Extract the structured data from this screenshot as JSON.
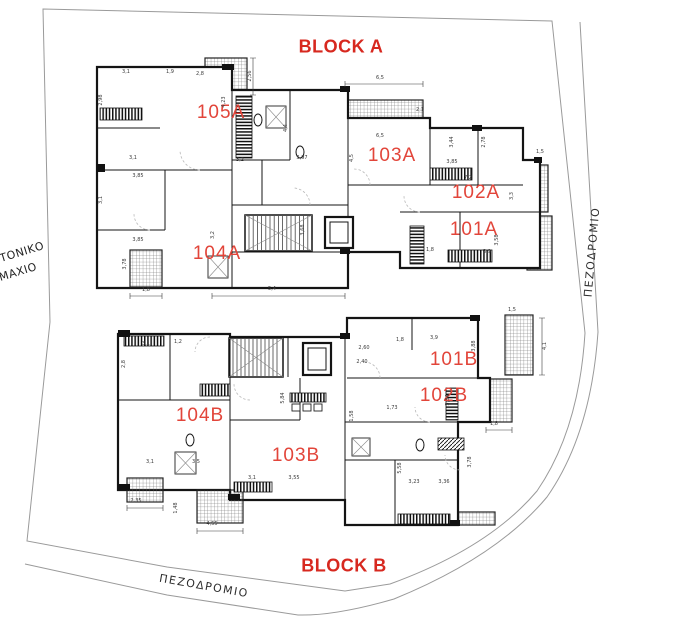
{
  "colors": {
    "block_label": "#d7281f",
    "unit_label": "#e2453a",
    "drawing": "#141414",
    "site_line": "#9a9a9a",
    "dimension_text": "#3a3a3a",
    "road_text": "#2e2e2e"
  },
  "labels": {
    "block_a": "BLOCK A",
    "block_b": "BLOCK B",
    "road_right": "ΠΕΖΟΔΡΟΜΙΟ",
    "road_bottom": "ΠΕΖΟΔΡΟΜΙΟ",
    "neighbor_line1": "ΤΟΝΙΚΟ",
    "neighbor_line2": "ΜΑΧΙΟ"
  },
  "units": [
    {
      "id": "105A",
      "x": 221,
      "y": 113
    },
    {
      "id": "103A",
      "x": 392,
      "y": 156
    },
    {
      "id": "102A",
      "x": 476,
      "y": 193
    },
    {
      "id": "101A",
      "x": 474,
      "y": 230
    },
    {
      "id": "104A",
      "x": 217,
      "y": 254
    },
    {
      "id": "101B",
      "x": 454,
      "y": 360
    },
    {
      "id": "102B",
      "x": 444,
      "y": 396
    },
    {
      "id": "104B",
      "x": 200,
      "y": 416
    },
    {
      "id": "103B",
      "x": 296,
      "y": 456
    }
  ],
  "dimensions": [
    {
      "t": "3,1",
      "x": 126,
      "y": 72,
      "r": 0
    },
    {
      "t": "1,9",
      "x": 170,
      "y": 72,
      "r": 0
    },
    {
      "t": "2,8",
      "x": 200,
      "y": 74,
      "r": 0
    },
    {
      "t": "2,98",
      "x": 101,
      "y": 100,
      "r": -90
    },
    {
      "t": "3,1",
      "x": 101,
      "y": 200,
      "r": -90
    },
    {
      "t": "3,1",
      "x": 133,
      "y": 158,
      "r": 0
    },
    {
      "t": "4,23",
      "x": 224,
      "y": 102,
      "r": -90
    },
    {
      "t": "2,56",
      "x": 250,
      "y": 76,
      "r": -90
    },
    {
      "t": "3,2",
      "x": 240,
      "y": 160,
      "r": 0
    },
    {
      "t": "3,97",
      "x": 302,
      "y": 158,
      "r": 0
    },
    {
      "t": "4,4",
      "x": 286,
      "y": 128,
      "r": -90
    },
    {
      "t": "3,85",
      "x": 138,
      "y": 176,
      "r": 0
    },
    {
      "t": "3,85",
      "x": 138,
      "y": 240,
      "r": 0
    },
    {
      "t": "3,78",
      "x": 125,
      "y": 264,
      "r": -90
    },
    {
      "t": "3,2",
      "x": 213,
      "y": 235,
      "r": -90
    },
    {
      "t": "6,5",
      "x": 380,
      "y": 78,
      "r": 0
    },
    {
      "t": "6,5",
      "x": 380,
      "y": 136,
      "r": 0
    },
    {
      "t": "4,5",
      "x": 352,
      "y": 158,
      "r": -90
    },
    {
      "t": "2,1",
      "x": 420,
      "y": 110,
      "r": 0
    },
    {
      "t": "2,78",
      "x": 484,
      "y": 142,
      "r": -90
    },
    {
      "t": "3,44",
      "x": 452,
      "y": 142,
      "r": -90
    },
    {
      "t": "3,85",
      "x": 452,
      "y": 162,
      "r": 0
    },
    {
      "t": "7,2",
      "x": 468,
      "y": 178,
      "r": 0
    },
    {
      "t": "3,3",
      "x": 512,
      "y": 196,
      "r": -90
    },
    {
      "t": "1,5",
      "x": 540,
      "y": 152,
      "r": 0
    },
    {
      "t": "3,58",
      "x": 497,
      "y": 240,
      "r": -90
    },
    {
      "t": "3,9",
      "x": 487,
      "y": 252,
      "r": 0
    },
    {
      "t": "1,8",
      "x": 430,
      "y": 250,
      "r": 0
    },
    {
      "t": "3,68",
      "x": 303,
      "y": 230,
      "r": -90
    },
    {
      "t": "5,4",
      "x": 272,
      "y": 289,
      "r": 0
    },
    {
      "t": "1,8",
      "x": 146,
      "y": 290,
      "r": 0
    },
    {
      "t": "3,1",
      "x": 146,
      "y": 344,
      "r": 0
    },
    {
      "t": "1,2",
      "x": 178,
      "y": 342,
      "r": 0
    },
    {
      "t": "2,8",
      "x": 124,
      "y": 364,
      "r": -90
    },
    {
      "t": "3,1",
      "x": 150,
      "y": 462,
      "r": 0
    },
    {
      "t": "3,5",
      "x": 196,
      "y": 462,
      "r": 0
    },
    {
      "t": "5,84",
      "x": 283,
      "y": 398,
      "r": -90
    },
    {
      "t": "3,1",
      "x": 252,
      "y": 478,
      "r": 0
    },
    {
      "t": "3,55",
      "x": 294,
      "y": 478,
      "r": 0
    },
    {
      "t": "2,60",
      "x": 364,
      "y": 348,
      "r": 0
    },
    {
      "t": "1,8",
      "x": 400,
      "y": 340,
      "r": 0
    },
    {
      "t": "3,9",
      "x": 434,
      "y": 338,
      "r": 0
    },
    {
      "t": "3,88",
      "x": 474,
      "y": 346,
      "r": -90
    },
    {
      "t": "2,40",
      "x": 362,
      "y": 362,
      "r": 0
    },
    {
      "t": "1,73",
      "x": 392,
      "y": 408,
      "r": 0
    },
    {
      "t": "1,58",
      "x": 352,
      "y": 416,
      "r": -90
    },
    {
      "t": "5,58",
      "x": 400,
      "y": 468,
      "r": -90
    },
    {
      "t": "3,23",
      "x": 414,
      "y": 482,
      "r": 0
    },
    {
      "t": "3,36",
      "x": 444,
      "y": 482,
      "r": 0
    },
    {
      "t": "3,78",
      "x": 470,
      "y": 462,
      "r": -90
    },
    {
      "t": "3,34",
      "x": 448,
      "y": 400,
      "r": -90
    },
    {
      "t": "4,55",
      "x": 212,
      "y": 524,
      "r": 0
    },
    {
      "t": "2,35",
      "x": 136,
      "y": 501,
      "r": 0
    },
    {
      "t": "1,48",
      "x": 176,
      "y": 508,
      "r": -90
    },
    {
      "t": "4,1",
      "x": 545,
      "y": 346,
      "r": -90
    },
    {
      "t": "1,8",
      "x": 494,
      "y": 424,
      "r": 0
    },
    {
      "t": "1,5",
      "x": 512,
      "y": 310,
      "r": 0
    }
  ]
}
